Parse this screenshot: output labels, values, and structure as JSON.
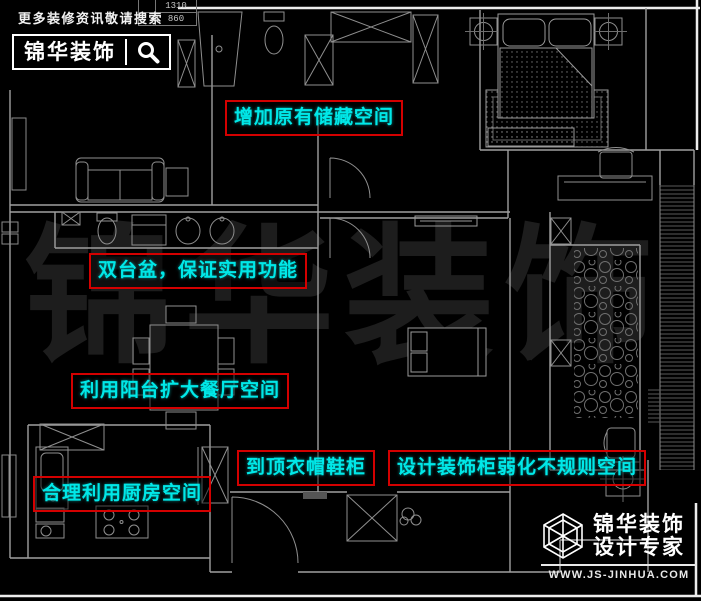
{
  "header": {
    "tagline": "更多装修资讯敬请搜索",
    "brand": "锦华装饰"
  },
  "dim_table": {
    "rows": [
      {
        "value": "1310"
      },
      {
        "value": "860"
      }
    ]
  },
  "watermark": {
    "text": "锦华装饰"
  },
  "annotations": [
    {
      "text": "增加原有储藏空间"
    },
    {
      "text": "双台盆，保证实用功能"
    },
    {
      "text": "利用阳台扩大餐厅空间"
    },
    {
      "text": "到顶衣帽鞋柜"
    },
    {
      "text": "设计装饰柜弱化不规则空间"
    },
    {
      "text": "合理利用厨房空间"
    }
  ],
  "footer": {
    "brand": "锦华装饰",
    "subtitle": "设计专家",
    "website": "WWW.JS-JINHUA.COM"
  },
  "colors": {
    "background": "#000000",
    "annotation_text": "#00e8e8",
    "annotation_border": "#d40000",
    "plan_line": "#9f9f9f",
    "watermark": "#1d1d1d",
    "logo_white": "#f2f2f2"
  }
}
